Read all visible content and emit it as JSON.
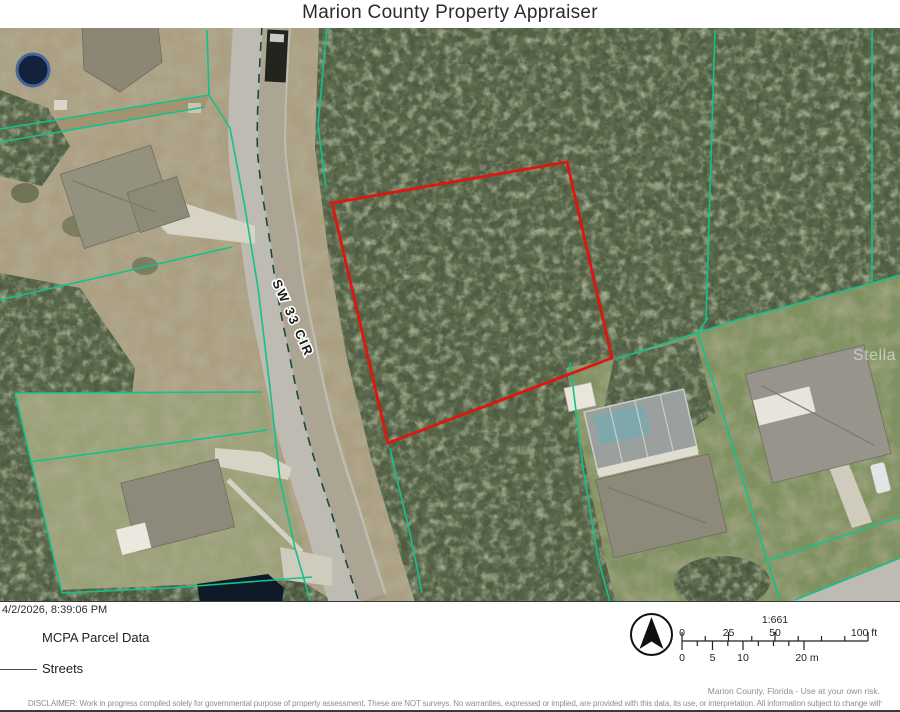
{
  "header": {
    "title": "Marion County Property Appraiser"
  },
  "map": {
    "street_label": "SW 33 CIR",
    "watermark_label": "Stella",
    "selected_parcel_color": "#df150f",
    "parcel_line_color": "#14c08c",
    "road_color": "#bdbbb2"
  },
  "footer": {
    "timestamp": "4/2/2026, 8:39:06 PM",
    "legend": [
      {
        "label": "MCPA Parcel Data",
        "symbol": "parcel-outline"
      },
      {
        "label": "Streets",
        "symbol": "street-line"
      }
    ],
    "north_arrow_icon": "north-arrow",
    "scalebar": {
      "ratio": "1:661",
      "feet_labels": [
        "0",
        "25",
        "50",
        "100 ft"
      ],
      "meter_labels": [
        "0",
        "5",
        "10",
        "20 m"
      ]
    },
    "attribution": "Marion County, Florida - Use at your own risk.",
    "disclaimer": "DISCLAIMER: Work in progress compiled solely for governmental purpose of property assessment. These are NOT surveys. No warranties, expressed or implied, are provided with this data, its use, or interpretation. All information subject to change without notice."
  }
}
